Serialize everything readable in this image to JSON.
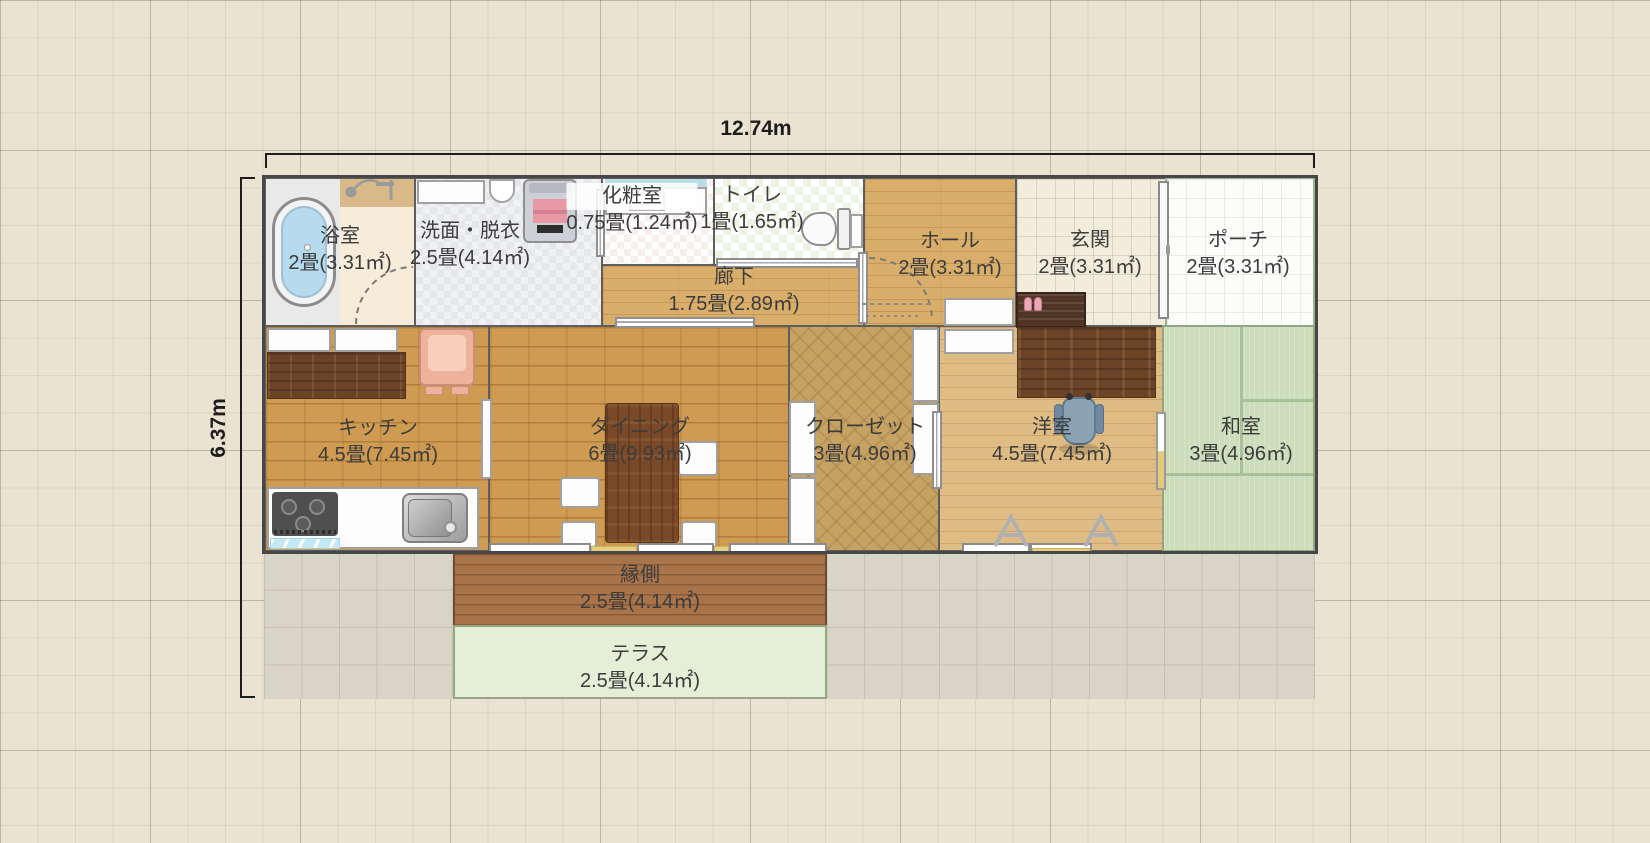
{
  "dimensions": {
    "width": "12.74m",
    "height": "6.37m"
  },
  "rooms": {
    "bathroom": {
      "name": "浴室",
      "size": "2畳(3.31㎡)"
    },
    "washroom": {
      "name": "洗面・脱衣",
      "size": "2.5畳(4.14㎡)"
    },
    "powder_room": {
      "name": "化粧室",
      "size": "0.75畳(1.24㎡)"
    },
    "toilet": {
      "name": "トイレ",
      "size": "1畳(1.65㎡)"
    },
    "corridor": {
      "name": "廊下",
      "size": "1.75畳(2.89㎡)"
    },
    "hall": {
      "name": "ホール",
      "size": "2畳(3.31㎡)"
    },
    "entrance": {
      "name": "玄関",
      "size": "2畳(3.31㎡)"
    },
    "porch": {
      "name": "ポーチ",
      "size": "2畳(3.31㎡)"
    },
    "kitchen": {
      "name": "キッチン",
      "size": "4.5畳(7.45㎡)"
    },
    "dining": {
      "name": "ダイニング",
      "size": "6畳(9.93㎡)"
    },
    "closet": {
      "name": "クローゼット",
      "size": "3畳(4.96㎡)"
    },
    "western_room": {
      "name": "洋室",
      "size": "4.5畳(7.45㎡)"
    },
    "japanese_room": {
      "name": "和室",
      "size": "3畳(4.96㎡)"
    },
    "veranda": {
      "name": "縁側",
      "size": "2.5畳(4.14㎡)"
    },
    "terrace": {
      "name": "テラス",
      "size": "2.5畳(4.14㎡)"
    }
  },
  "colors": {
    "background": "#ebe3d2",
    "wall": "#5e5e5e",
    "wood_floor": "#d9ae6b",
    "western_floor": "#dfbc84",
    "brick_floor": "#cf9b52",
    "closet_floor": "#c6a263",
    "tatami_green": "#cbddba",
    "veranda_brown": "#a9744a",
    "terrace_green": "#e5eed7",
    "ground_tile": "#d9d4c8",
    "entrance_tile": "#f2ecdc",
    "bath_water_blue": "#b7dbee",
    "accent_pink": "#e79aa6",
    "dimension_line": "#1d1d1d",
    "label_text": "#3c3c3c"
  },
  "icons": [
    "bathtub-icon",
    "shower-icon",
    "vanity-icon",
    "washbasin-icon",
    "washing-machine-icon",
    "powder-vanity-icon",
    "toilet-icon",
    "sliding-door-icon",
    "door-swing-arc-icon",
    "storage-cabinet-icon",
    "shoe-cabinet-icon",
    "slippers-icon",
    "front-door-icon",
    "kitchen-cabinet-icon",
    "kitchen-counter-icon",
    "armchair-icon",
    "stove-icon",
    "stove-mat-icon",
    "kitchen-sink-icon",
    "dining-table-icon",
    "chair-icon",
    "closet-panel-icon",
    "dresser-icon",
    "desk-icon",
    "office-chair-icon",
    "window-icon",
    "window-sill-icon",
    "drying-rack-icon",
    "tatami-mat-lines"
  ]
}
